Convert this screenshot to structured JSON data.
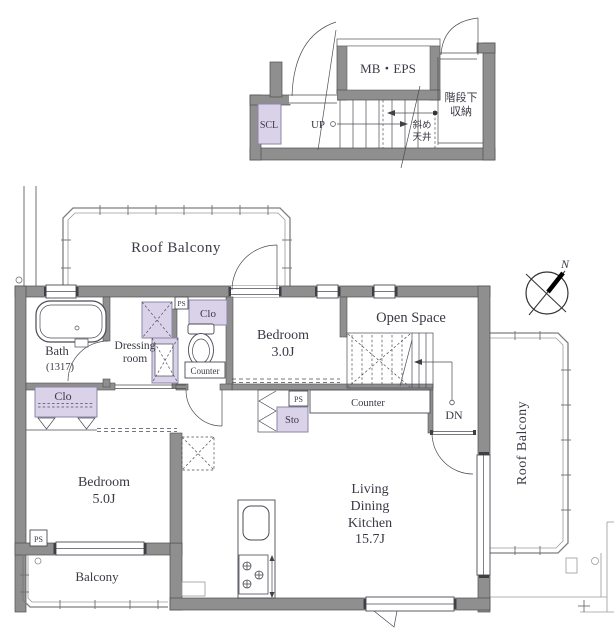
{
  "colors": {
    "wall": "#8f8f8f",
    "wall-stroke": "#4f4f4f",
    "line": "#4b4b55",
    "text": "#3a3a46",
    "closet": "#d9d2e8",
    "closet-stroke": "#8d85a8",
    "rail": "#7f7f7f",
    "bg": "#ffffff"
  },
  "upper": {
    "mb_eps": "MB・EPS",
    "scl": "SCL",
    "up": "UP",
    "understair_line1": "階段下",
    "understair_line2": "収納",
    "slant_line1": "斜め",
    "slant_line2": "天井"
  },
  "main": {
    "roof_balcony_top": "Roof Balcony",
    "roof_balcony_right": "Roof Balcony",
    "balcony": "Balcony",
    "bath_line1": "Bath",
    "bath_line2": "(1317)",
    "dressing_line1": "Dressing",
    "dressing_line2": "room",
    "clo_top": "Clo",
    "clo_hall": "Clo",
    "ps_top": "PS",
    "ps_mid": "PS",
    "ps_bottom": "PS",
    "sto": "Sto",
    "counter_toilet": "Counter",
    "counter_mid": "Counter",
    "bedroom3_line1": "Bedroom",
    "bedroom3_line2": "3.0J",
    "bedroom5_line1": "Bedroom",
    "bedroom5_line2": "5.0J",
    "open_space": "Open Space",
    "ldk_line1": "Living",
    "ldk_line2": "Dining",
    "ldk_line3": "Kitchen",
    "ldk_line4": "15.7J",
    "dn": "DN"
  },
  "compass": {
    "north": "N"
  }
}
